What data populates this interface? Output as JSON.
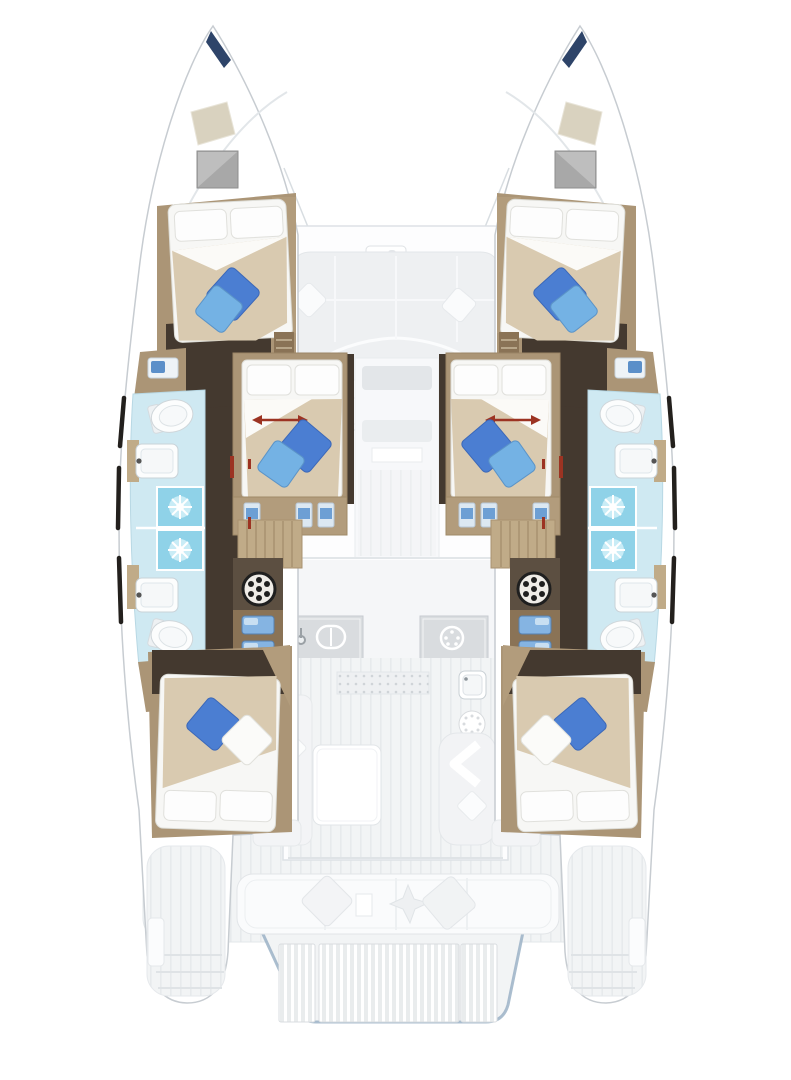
{
  "meta": {
    "title": "Catamaran yacht deck and accommodation floor plan, bow up, six double cabins and four bathrooms",
    "view": "top-down floor plan",
    "vessel_type": "sailing catamaran"
  },
  "palette": {
    "hull_fill": "#ffffff",
    "hull_stroke": "#c7ccd1",
    "deck": "#f2f4f5",
    "deck_line": "#e3e7ea",
    "floor_dark": "#44392f",
    "floor_dark2": "#5c4f41",
    "wood_tan": "#ab9576",
    "wood_mid": "#b29c7c",
    "wood_tan_light": "#c0ab88",
    "wood_tan_dark": "#8a7356",
    "mattress": "#f7f7f5",
    "pillow_white": "#fdfdfd",
    "duvet": "#d9cab0",
    "sheet_white": "#fbfaf7",
    "pillow_blue": "#4b7ed2",
    "pillow_blue_light": "#74b2e4",
    "bath_floor": "#cfe9f2",
    "shower": "#8fd2e8",
    "fixture_white": "#fcfdfd",
    "counter_gray": "#d9dcdf",
    "hatch_gray": "#a8a8a8",
    "bow_navy": "#2e4469",
    "accent_red": "#9c3322",
    "drawer_blue": "#85b4e2",
    "platform_edge": "#8fa8bf",
    "window_dark": "#23201d"
  },
  "layout": {
    "symmetry": "port and starboard hulls mirrored",
    "counts": {
      "cabins": 6,
      "double_berths": 6,
      "bathrooms": 4,
      "showers": 4,
      "toilets": 4,
      "vanity_sinks": 4
    },
    "regions": [
      {
        "id": "port-bow",
        "name": "port bow with anchor locker and deck hatches"
      },
      {
        "id": "starboard-bow",
        "name": "starboard bow with deck hatches"
      },
      {
        "id": "forward-cockpit",
        "name": "forward cockpit with U-sofa and table"
      },
      {
        "id": "port-forward-cabin",
        "name": "port forward double cabin"
      },
      {
        "id": "starboard-forward-cabin",
        "name": "starboard forward double cabin"
      },
      {
        "id": "port-middle-cabin",
        "name": "port inboard double cabin with sliding berth arrow"
      },
      {
        "id": "starboard-middle-cabin",
        "name": "starboard inboard double cabin with sliding berth arrow"
      },
      {
        "id": "port-forward-bathroom",
        "name": "port forward bathroom with toilet, vanity and shower"
      },
      {
        "id": "port-aft-bathroom",
        "name": "port aft bathroom with shower, vanity and toilet"
      },
      {
        "id": "starboard-forward-bathroom",
        "name": "starboard forward bathroom with toilet, vanity and shower"
      },
      {
        "id": "starboard-aft-bathroom",
        "name": "starboard aft bathroom with shower, vanity and toilet"
      },
      {
        "id": "galley",
        "name": "central galley with sink and cooktop"
      },
      {
        "id": "saloon",
        "name": "saloon with table and settees"
      },
      {
        "id": "port-aft-cabin",
        "name": "port aft double cabin"
      },
      {
        "id": "starboard-aft-cabin",
        "name": "starboard aft double cabin"
      },
      {
        "id": "aft-cockpit",
        "name": "aft cockpit with bench seat and cushions"
      },
      {
        "id": "swim-platform",
        "name": "aft swim platform with teak grating"
      }
    ]
  }
}
